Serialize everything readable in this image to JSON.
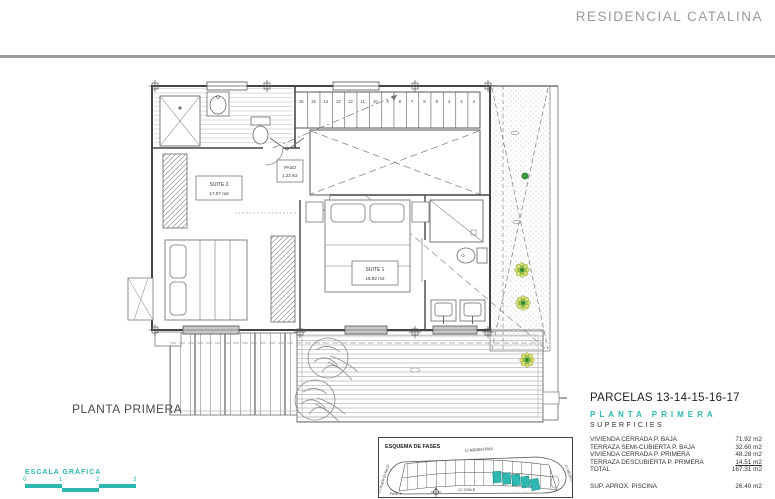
{
  "header": {
    "title": "RESIDENCIAL CATALINA"
  },
  "plan": {
    "caption": "PLANTA PRIMERA",
    "rooms": {
      "suite2": {
        "name": "SUITE 2",
        "area": "17.07 m2"
      },
      "paso": {
        "name": "PASO",
        "area": "1.23 m2"
      },
      "suite1": {
        "name": "SUITE 1",
        "area": "18.82 m2"
      }
    },
    "stair_numbers": [
      "16",
      "15",
      "14",
      "13",
      "12",
      "11",
      "10",
      "9",
      "8",
      "7",
      "6",
      "5",
      "4",
      "3",
      "2"
    ]
  },
  "scale_bar": {
    "label": "ESCALA GRÁFICA",
    "ticks": [
      "0",
      "1",
      "2",
      "3"
    ]
  },
  "fases": {
    "title": "ESQUEMA DE FASES",
    "streets": {
      "top": "C/ ARGENTINA",
      "bottom": "C/ CHILE",
      "left": "C/ PUERTO RICO",
      "right": "C/ MEJICO"
    },
    "fase_label": "FASE 1"
  },
  "parcels": {
    "title": "PARCELAS 13-14-15-16-17",
    "subtitle": "PLANTA PRIMERA",
    "section": "SUPERFICIES",
    "rows": [
      {
        "label": "VIVIENDA CERRADA P. BAJA",
        "value": "71.92 m2"
      },
      {
        "label": "TERRAZA SEMI-CUBIERTA P. BAJA",
        "value": "32.60 m2"
      },
      {
        "label": "VIVIENDA CERRADA P. PRIMERA",
        "value": "48.28 m2"
      },
      {
        "label": "TERRAZA DESCUBIERTA P. PRIMERA",
        "value": "14.51 m2"
      },
      {
        "label": "TOTAL",
        "value": "167.31 m2"
      }
    ],
    "piscina": {
      "label": "SUP. APROX. PISCINA",
      "value": "26.40 m2"
    }
  },
  "colors": {
    "accent_teal": "#2eb8b2",
    "header_gray": "#9a9a9a",
    "plant_green": "#2e8b2e"
  }
}
